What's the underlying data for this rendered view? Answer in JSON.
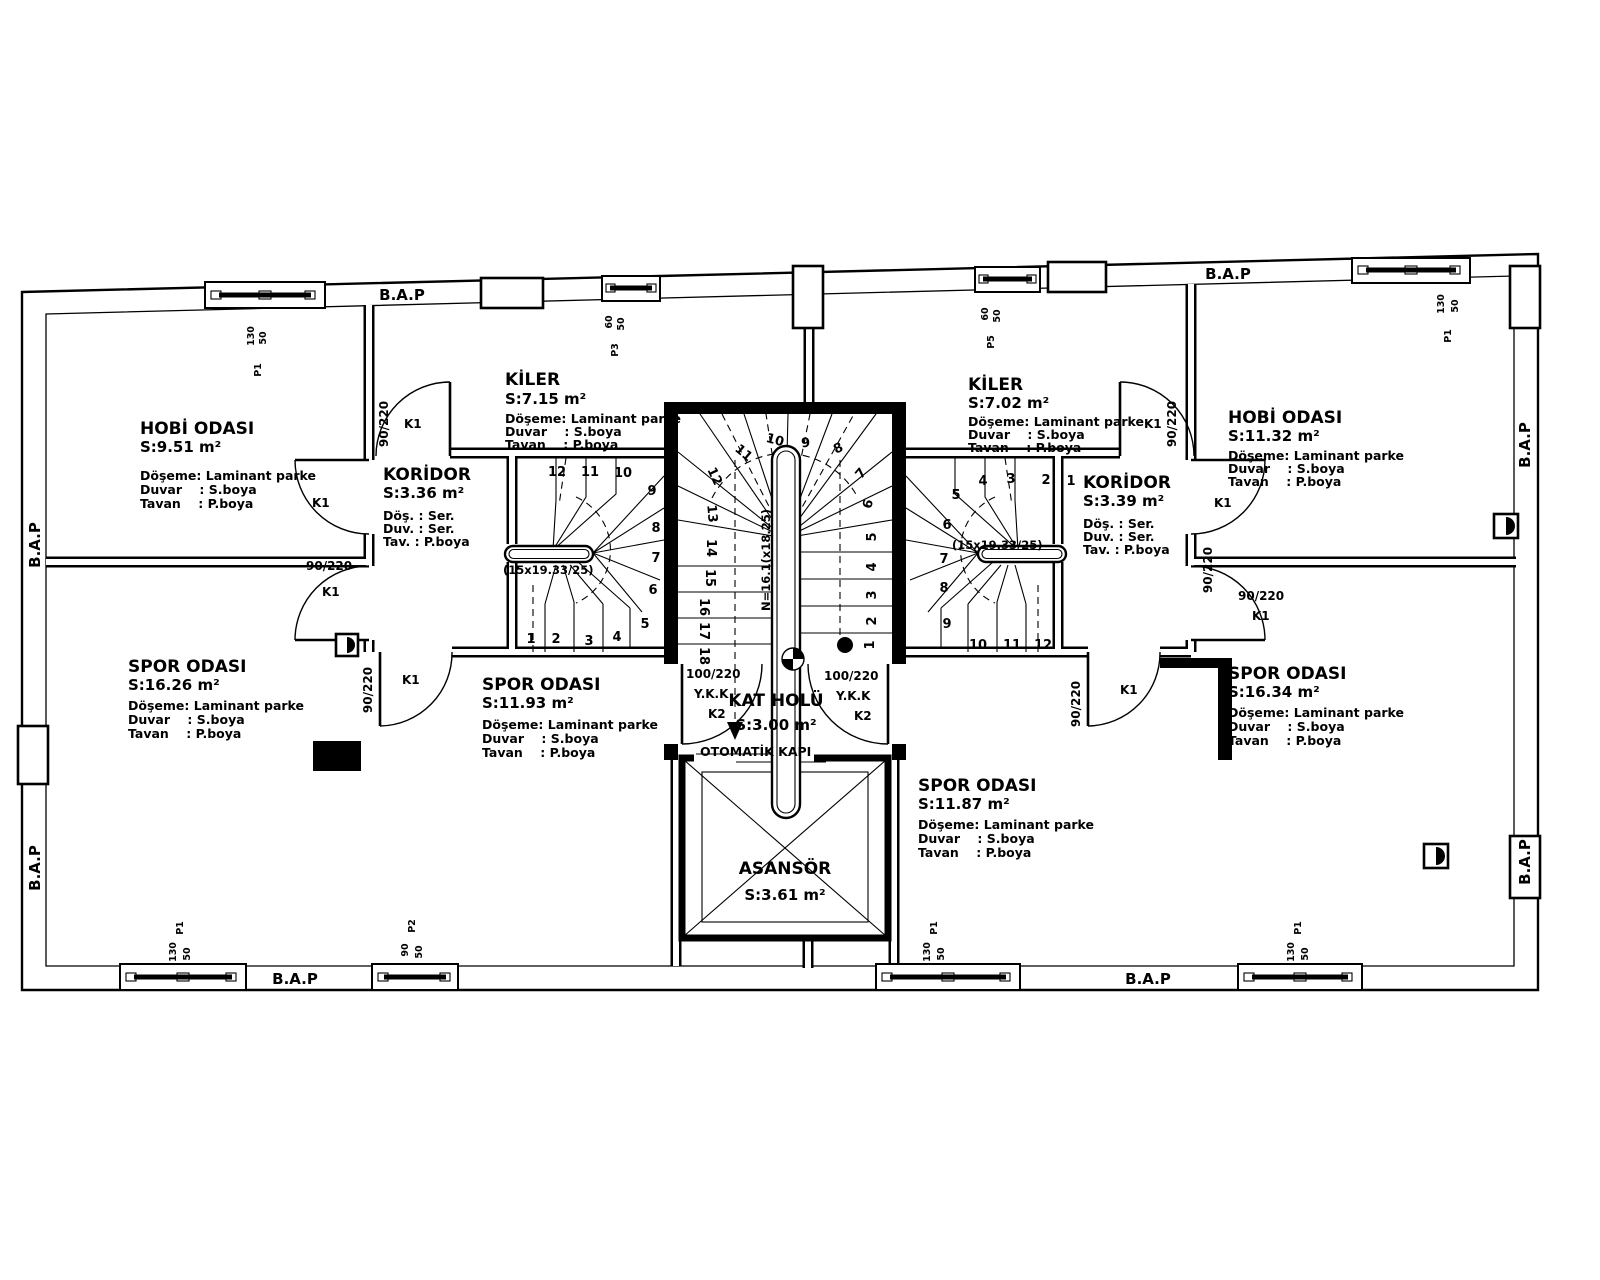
{
  "labels": {
    "bap": "B.A.P",
    "otomatik_kapi": "OTOMATİK KAPI"
  },
  "rooms": [
    {
      "name": "HOBİ ODASI",
      "area": "S:9.51 m²",
      "l1": "Döşeme: Laminant parke",
      "l2": "Duvar    : S.boya",
      "l3": "Tavan    : P.boya"
    },
    {
      "name": "KİLER",
      "area": "S:7.15 m²",
      "l1": "Döşeme: Laminant parke",
      "l2": "Duvar    : S.boya",
      "l3": "Tavan    : P.boya"
    },
    {
      "name": "KORİDOR",
      "area": "S:3.36 m²",
      "l1": "Döş. : Ser.",
      "l2": "Duv. : Ser.",
      "l3": "Tav. : P.boya"
    },
    {
      "name": "SPOR ODASI",
      "area": "S:16.26 m²",
      "l1": "Döşeme: Laminant parke",
      "l2": "Duvar    : S.boya",
      "l3": "Tavan    : P.boya"
    },
    {
      "name": "SPOR ODASI",
      "area": "S:11.93 m²",
      "l1": "Döşeme: Laminant parke",
      "l2": "Duvar    : S.boya",
      "l3": "Tavan    : P.boya"
    },
    {
      "name": "KAT HOLÜ",
      "area": "S:3.00 m²"
    },
    {
      "name": "ASANSÖR",
      "area": "S:3.61 m²"
    },
    {
      "name": "KİLER",
      "area": "S:7.02 m²",
      "l1": "Döşeme: Laminant parke",
      "l2": "Duvar    : S.boya",
      "l3": "Tavan    : P.boya"
    },
    {
      "name": "KORİDOR",
      "area": "S:3.39 m²",
      "l1": "Döş. : Ser.",
      "l2": "Duv. : Ser.",
      "l3": "Tav. : P.boya"
    },
    {
      "name": "HOBİ ODASI",
      "area": "S:11.32 m²",
      "l1": "Döşeme: Laminant parke",
      "l2": "Duvar    : S.boya",
      "l3": "Tavan    : P.boya"
    },
    {
      "name": "SPOR ODASI",
      "area": "S:16.34 m²",
      "l1": "Döşeme: Laminant parke",
      "l2": "Duvar    : S.boya",
      "l3": "Tavan    : P.boya"
    },
    {
      "name": "SPOR ODASI",
      "area": "S:11.87 m²",
      "l1": "Döşeme: Laminant parke",
      "l2": "Duvar    : S.boya",
      "l3": "Tavan    : P.boya"
    }
  ],
  "doors": {
    "k1": "K1",
    "k2": "K2",
    "size_k1": "90/220",
    "size_k2": "100/220",
    "ykk": "Y.K.K"
  },
  "windows": {
    "w130": "130",
    "w90": "90",
    "w60": "60",
    "h50": "50",
    "p1": "P1",
    "p2": "P2",
    "p3": "P3",
    "p5": "P5"
  },
  "stairs": {
    "side_note": "(15x19.33/25)",
    "center_note": "N=16.1(x18.25)",
    "left": [
      "1",
      "2",
      "3",
      "4",
      "5",
      "6",
      "7",
      "8",
      "9",
      "10",
      "11",
      "12"
    ],
    "right": [
      "1",
      "2",
      "3",
      "4",
      "5",
      "6",
      "7",
      "8",
      "9",
      "10",
      "11",
      "12"
    ],
    "center": [
      "1",
      "2",
      "3",
      "4",
      "5",
      "6",
      "7",
      "8",
      "9",
      "10",
      "11",
      "12",
      "13",
      "14",
      "15",
      "16",
      "17",
      "18"
    ]
  }
}
